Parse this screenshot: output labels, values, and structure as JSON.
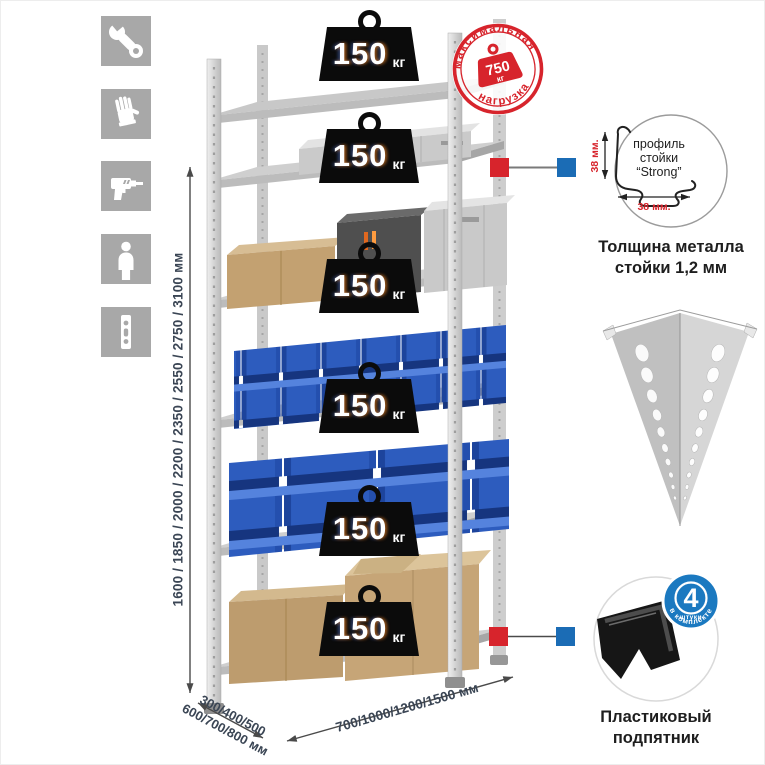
{
  "colors": {
    "accent_red": "#d7242c",
    "accent_blue": "#1b6cb5",
    "bin_blue": "#2d5cbe",
    "cardboard": "#c3a171",
    "metal_gray": "#d2d2d2",
    "icon_bg_gray": "#a8a8a8",
    "dim_text": "#3a4554"
  },
  "sidebar": {
    "icons": [
      {
        "name": "wrench-icon"
      },
      {
        "name": "gloves-icon"
      },
      {
        "name": "drill-icon"
      },
      {
        "name": "person-icon"
      },
      {
        "name": "upright-profile-icon"
      }
    ]
  },
  "rack": {
    "shelf_count": 6,
    "load_value": "150",
    "load_unit": "кг"
  },
  "stamp": {
    "arc_top": "максимальная",
    "arc_bottom": "нагрузка",
    "value": "750",
    "unit": "кг"
  },
  "dimensions": {
    "height": "1600 / 1850 / 2000 / 2200 / 2350 / 2550 / 2750 / 3100 мм",
    "depth_line1": "300/400/500",
    "depth_line2": "600/700/800 мм",
    "width": "700/1000/1200/1500 мм"
  },
  "profile_detail": {
    "line1": "профиль",
    "line2": "стойки",
    "line3": "“Strong”",
    "dim_v": "38 мм.",
    "dim_h": "38 мм.",
    "caption1": "Толщина металла",
    "caption2": "стойки 1,2 мм"
  },
  "foot_detail": {
    "badge_value": "4",
    "badge_small": "штуки",
    "badge_arc": "в комплекте",
    "caption1": "Пластиковый",
    "caption2": "подпятник"
  }
}
